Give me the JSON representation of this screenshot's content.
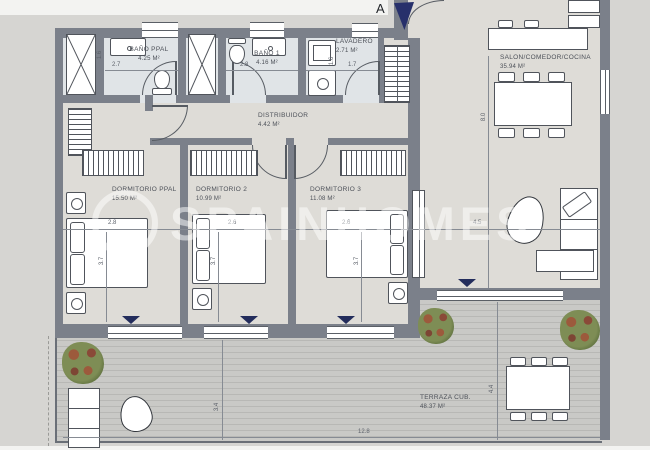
{
  "marker": "A",
  "watermark": "SPAINHOMES",
  "rooms": {
    "bano_ppal": {
      "name": "BAÑO PPAL",
      "area": "4.25 m²"
    },
    "bano_1": {
      "name": "BAÑO 1",
      "area": "4.16 m²"
    },
    "lavadero": {
      "name": "LAVADERO",
      "area": "2.71 m²"
    },
    "distribuidor": {
      "name": "DISTRIBUIDOR",
      "area": "4.42 m²"
    },
    "salon": {
      "name": "SALON/COMEDOR/COCINA",
      "area": "35.94 m²"
    },
    "dorm_ppal": {
      "name": "DORMITORIO PPAL",
      "area": "15.50 m²"
    },
    "dorm_2": {
      "name": "DORMITORIO 2",
      "area": "10.99 m²"
    },
    "dorm_3": {
      "name": "DORMITORIO 3",
      "area": "11.08 m²"
    },
    "terraza": {
      "name": "TERRAZA CUB.",
      "area": "48.37 m²"
    }
  },
  "dims": {
    "bano_ppal_w": "2.7",
    "bano_ppal_d": "1.6",
    "bano_1_w": "2.8",
    "lavadero_w": "1.7",
    "lavadero_d": "1.6",
    "dorm_ppal_w": "2.8",
    "dorm_ppal_d": "3.7",
    "dorm_2_w": "2.6",
    "dorm_2_d": "3.7",
    "dorm_3_w": "2.6",
    "dorm_3_d": "3.7",
    "salon_w": "4.5",
    "salon_d": "8.0",
    "terraza_w": "12.8",
    "terraza_left_d": "3.4",
    "terraza_right_d": "4.4"
  },
  "colors": {
    "wall": "#7b808a",
    "floor": "#dedcd7",
    "bath_floor": "#e0e4e7",
    "terrace": "#c9c9c6",
    "window_marker_navy": "#232d5c",
    "background": "#d6d5d2"
  }
}
